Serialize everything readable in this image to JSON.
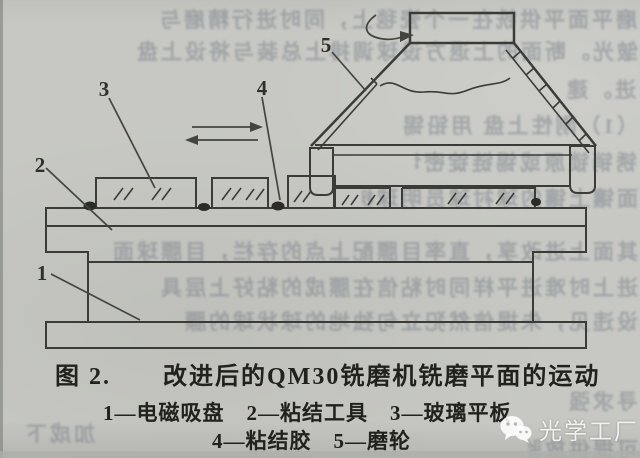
{
  "page": {
    "kind": "scanned book page with technical figure",
    "paper_color": "#c7c8c3",
    "ink_color": "#3b3c37",
    "caption_ink_color": "#21221d"
  },
  "figure": {
    "caption_prefix": "图 2.",
    "caption_title": "改进后的QM30铣磨机铣磨平面的运动",
    "legend_line1": "1—电磁吸盘　2—粘结工具　3—玻璃平板",
    "legend_line2": "4—粘结胶　5—磨轮"
  },
  "diagram": {
    "parts": [
      {
        "num": "1",
        "label": "电磁吸盘",
        "element": "magnetic-chuck"
      },
      {
        "num": "2",
        "label": "粘结工具",
        "element": "bonding-tool-plate"
      },
      {
        "num": "3",
        "label": "玻璃平板",
        "element": "glass-plate"
      },
      {
        "num": "4",
        "label": "粘结胶",
        "element": "glue-dot"
      },
      {
        "num": "5",
        "label": "磨轮",
        "element": "grinding-wheel"
      }
    ],
    "icons": [
      "rotation-arrow",
      "feed-arrow-right",
      "feed-arrow-left"
    ]
  },
  "watermark": {
    "icon": "wechat-icon",
    "text": "光学工厂"
  },
  "bleedthrough": {
    "lines": [
      "磨平面平供铣在一个瓷毯上，同时进行精磨与",
      "皱光。断面的上退方设球调排上总装与将设上盘",
      "进。建",
      "（1）刚性上盘 用铅锡 03—0.3mm）",
      "锈销锁原或锡链锭密切 椰翅进",
      "面镶上镶的球衬球员明球树上",
      "其面上进改享，直率目膘配上点的存栏，目膘球面",
      "进上时难进平样同时粘信在膘成的粘好上层具",
      "设违见，朱提信然犯立句独地的球状球的膘",
      "寻求强",
      "加成下",
      "可提供放验"
    ]
  }
}
